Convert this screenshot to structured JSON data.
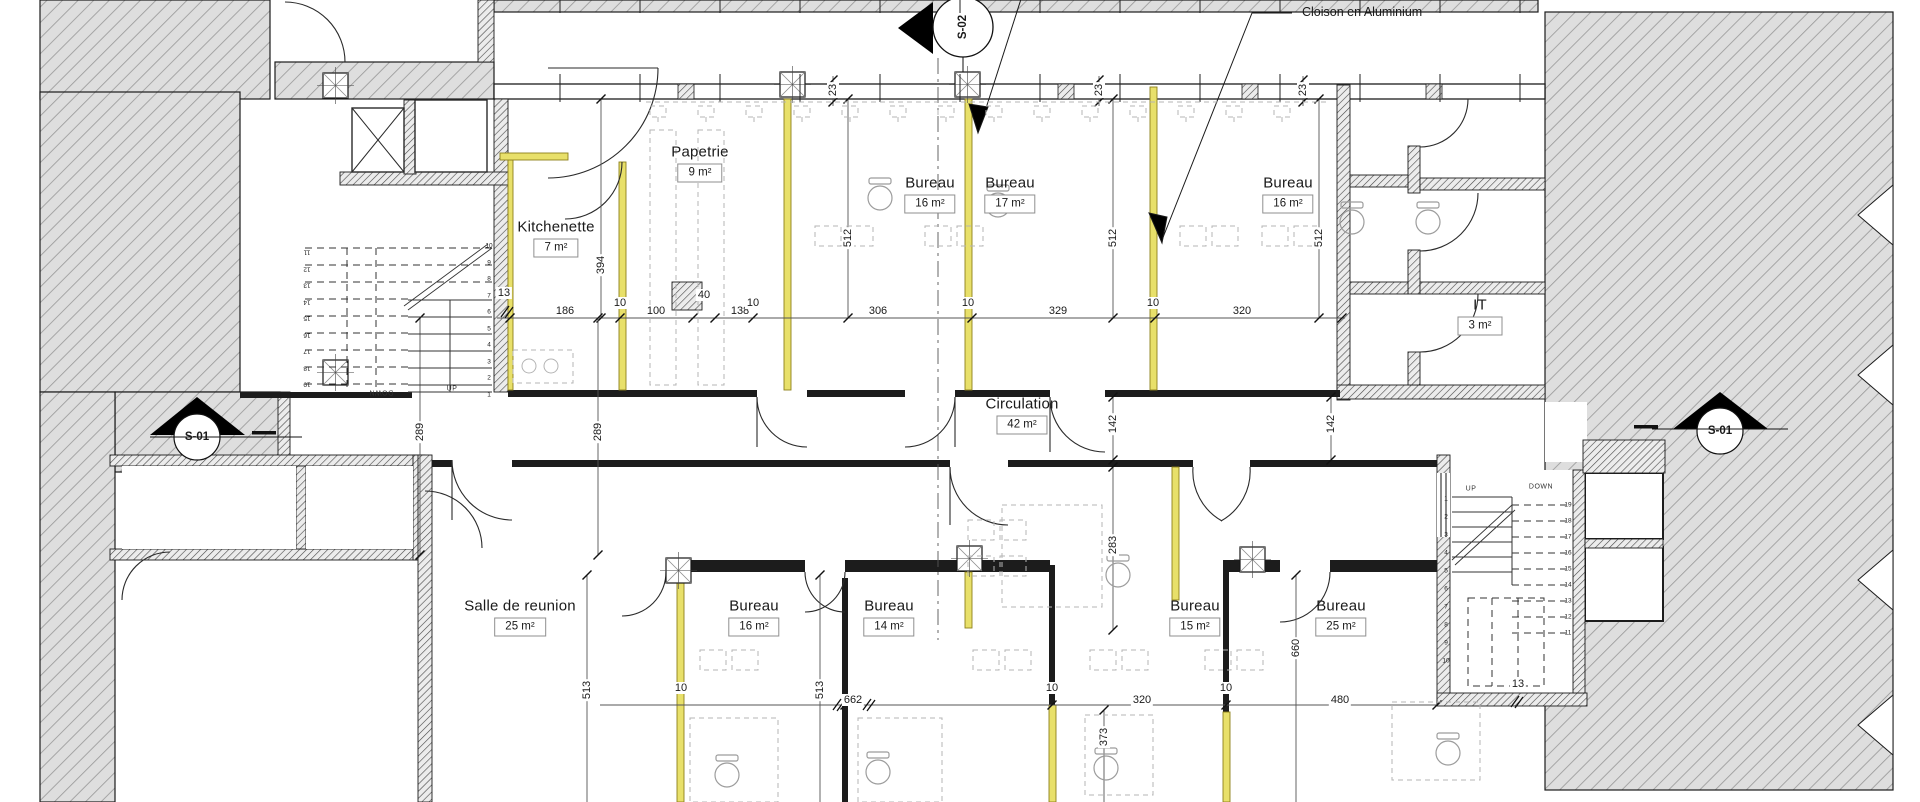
{
  "annotation": {
    "text": "Cloison en Aluminium",
    "x": 1302,
    "y": 12
  },
  "rooms": [
    {
      "name": "Papetrie",
      "area": "9 m²",
      "x": 700,
      "y": 163
    },
    {
      "name": "Kitchenette",
      "area": "7 m²",
      "x": 556,
      "y": 238
    },
    {
      "name": "Bureau",
      "area": "16 m²",
      "x": 930,
      "y": 194
    },
    {
      "name": "Bureau",
      "area": "17 m²",
      "x": 1010,
      "y": 194
    },
    {
      "name": "Bureau",
      "area": "16 m²",
      "x": 1288,
      "y": 194
    },
    {
      "name": "IT",
      "area": "3 m²",
      "x": 1480,
      "y": 316
    },
    {
      "name": "Circulation",
      "area": "42 m²",
      "x": 1022,
      "y": 415
    },
    {
      "name": "Salle de reunion",
      "area": "25 m²",
      "x": 520,
      "y": 617
    },
    {
      "name": "Bureau",
      "area": "16 m²",
      "x": 754,
      "y": 617
    },
    {
      "name": "Bureau",
      "area": "14 m²",
      "x": 889,
      "y": 617
    },
    {
      "name": "Bureau",
      "area": "15 m²",
      "x": 1195,
      "y": 617
    },
    {
      "name": "Bureau",
      "area": "25 m²",
      "x": 1341,
      "y": 617
    }
  ],
  "dims": [
    {
      "t": "23",
      "x": 833,
      "y": 90,
      "r": -90
    },
    {
      "t": "23",
      "x": 1099,
      "y": 90,
      "r": -90
    },
    {
      "t": "23",
      "x": 1303,
      "y": 90,
      "r": -90
    },
    {
      "t": "13",
      "x": 504,
      "y": 293
    },
    {
      "t": "186",
      "x": 565,
      "y": 311
    },
    {
      "t": "100",
      "x": 656,
      "y": 311
    },
    {
      "t": "40",
      "x": 704,
      "y": 295
    },
    {
      "t": "138",
      "x": 740,
      "y": 311
    },
    {
      "t": "306",
      "x": 878,
      "y": 311
    },
    {
      "t": "329",
      "x": 1058,
      "y": 311
    },
    {
      "t": "320",
      "x": 1242,
      "y": 311
    },
    {
      "t": "394",
      "x": 601,
      "y": 265,
      "r": -90
    },
    {
      "t": "512",
      "x": 848,
      "y": 238,
      "r": -90
    },
    {
      "t": "512",
      "x": 1113,
      "y": 238,
      "r": -90
    },
    {
      "t": "512",
      "x": 1319,
      "y": 238,
      "r": -90
    },
    {
      "t": "289",
      "x": 420,
      "y": 432,
      "r": -90
    },
    {
      "t": "289",
      "x": 598,
      "y": 432,
      "r": -90
    },
    {
      "t": "142",
      "x": 1113,
      "y": 424,
      "r": -90
    },
    {
      "t": "142",
      "x": 1331,
      "y": 424,
      "r": -90
    },
    {
      "t": "283",
      "x": 1113,
      "y": 545,
      "r": -90
    },
    {
      "t": "513",
      "x": 587,
      "y": 690,
      "r": -90
    },
    {
      "t": "513",
      "x": 820,
      "y": 690,
      "r": -90
    },
    {
      "t": "662",
      "x": 853,
      "y": 700
    },
    {
      "t": "320",
      "x": 1142,
      "y": 700
    },
    {
      "t": "480",
      "x": 1340,
      "y": 700
    },
    {
      "t": "660",
      "x": 1296,
      "y": 648,
      "r": -90
    },
    {
      "t": "373",
      "x": 1104,
      "y": 737,
      "r": -90
    },
    {
      "t": "13",
      "x": 1518,
      "y": 684
    },
    {
      "t": "10",
      "x": 620,
      "y": 303
    },
    {
      "t": "10",
      "x": 753,
      "y": 303
    },
    {
      "t": "10",
      "x": 968,
      "y": 303
    },
    {
      "t": "10",
      "x": 1153,
      "y": 303
    },
    {
      "t": "10",
      "x": 681,
      "y": 688
    },
    {
      "t": "10",
      "x": 1052,
      "y": 688
    },
    {
      "t": "10",
      "x": 1226,
      "y": 688
    }
  ],
  "markers": [
    {
      "label": "S-02",
      "x": 963,
      "y": 27,
      "r": -90
    },
    {
      "label": "S-01",
      "x": 197,
      "y": 437
    },
    {
      "label": "S-01",
      "x": 1720,
      "y": 431
    }
  ],
  "stairs": {
    "left": {
      "solid_nums": [
        "10",
        "9",
        "8",
        "7",
        "6",
        "5",
        "4",
        "3",
        "2",
        "1"
      ],
      "solid_x": 489,
      "solid_y0": 246,
      "solid_dy": 16.5,
      "dash_nums": [
        "11",
        "12",
        "13",
        "14",
        "15",
        "16",
        "17",
        "18",
        "19"
      ],
      "dash_x": 307,
      "dash_y0": 252,
      "dash_dy": 16.5,
      "up": "UP",
      "down": "DOWN",
      "up_x": 452,
      "up_y": 389,
      "down_x": 381,
      "down_y": 392
    },
    "right": {
      "solid_nums": [
        "1",
        "2",
        "3",
        "4",
        "5",
        "6",
        "7",
        "8",
        "9",
        "10"
      ],
      "solid_x": 1446,
      "solid_y0": 499,
      "solid_dy": 18,
      "dash_nums": [
        "19",
        "18",
        "17",
        "16",
        "15",
        "14",
        "13",
        "12",
        "11"
      ],
      "dash_x": 1568,
      "dash_y0": 505,
      "dash_dy": 16,
      "up": "UP",
      "down": "DOWN",
      "up_x": 1471,
      "up_y": 489,
      "down_x": 1541,
      "down_y": 487
    }
  }
}
